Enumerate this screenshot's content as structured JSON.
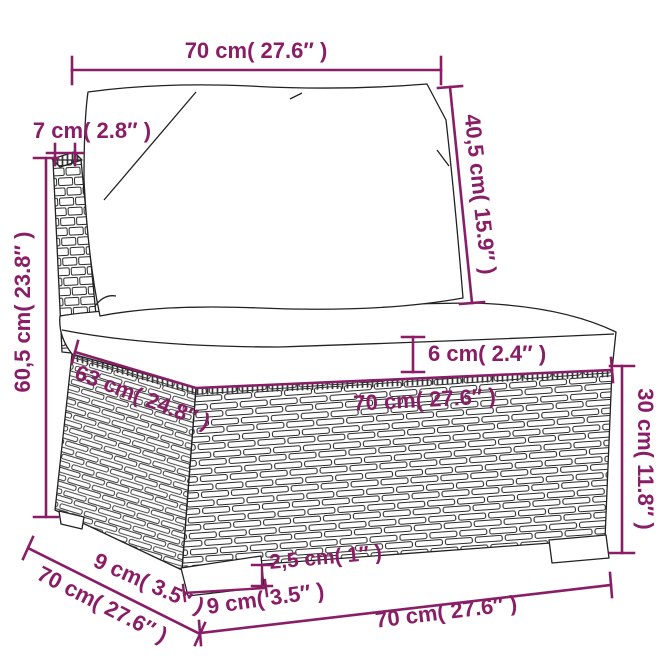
{
  "diagram": {
    "product": "rattan-sofa-middle-section-with-cushions",
    "colors": {
      "dimension": "#8a1e66",
      "line_art": "#222222",
      "background": "#ffffff",
      "cushion_fill": "#ffffff"
    },
    "measurements": {
      "top_width": "70 cm( 27.6″ )",
      "panel_thickness": "7 cm( 2.8″ )",
      "back_cushion_height": "40,5 cm( 15.9″ )",
      "total_height": "60,5 cm( 23.8″ )",
      "seat_depth": "63 cm( 24.8″ )",
      "cushion_thickness": "6 cm( 2.4″ )",
      "seat_width": "70 cm( 27.6″ )",
      "base_height": "30 cm( 11.8″ )",
      "foot_depth": "9 cm( 3.5″ )",
      "depth": "70 cm( 27.6″ )",
      "foot_height": "2,5 cm( 1″ )",
      "foot_width": "9 cm( 3.5″ )",
      "bottom_width": "70 cm( 27.6″ )"
    }
  }
}
